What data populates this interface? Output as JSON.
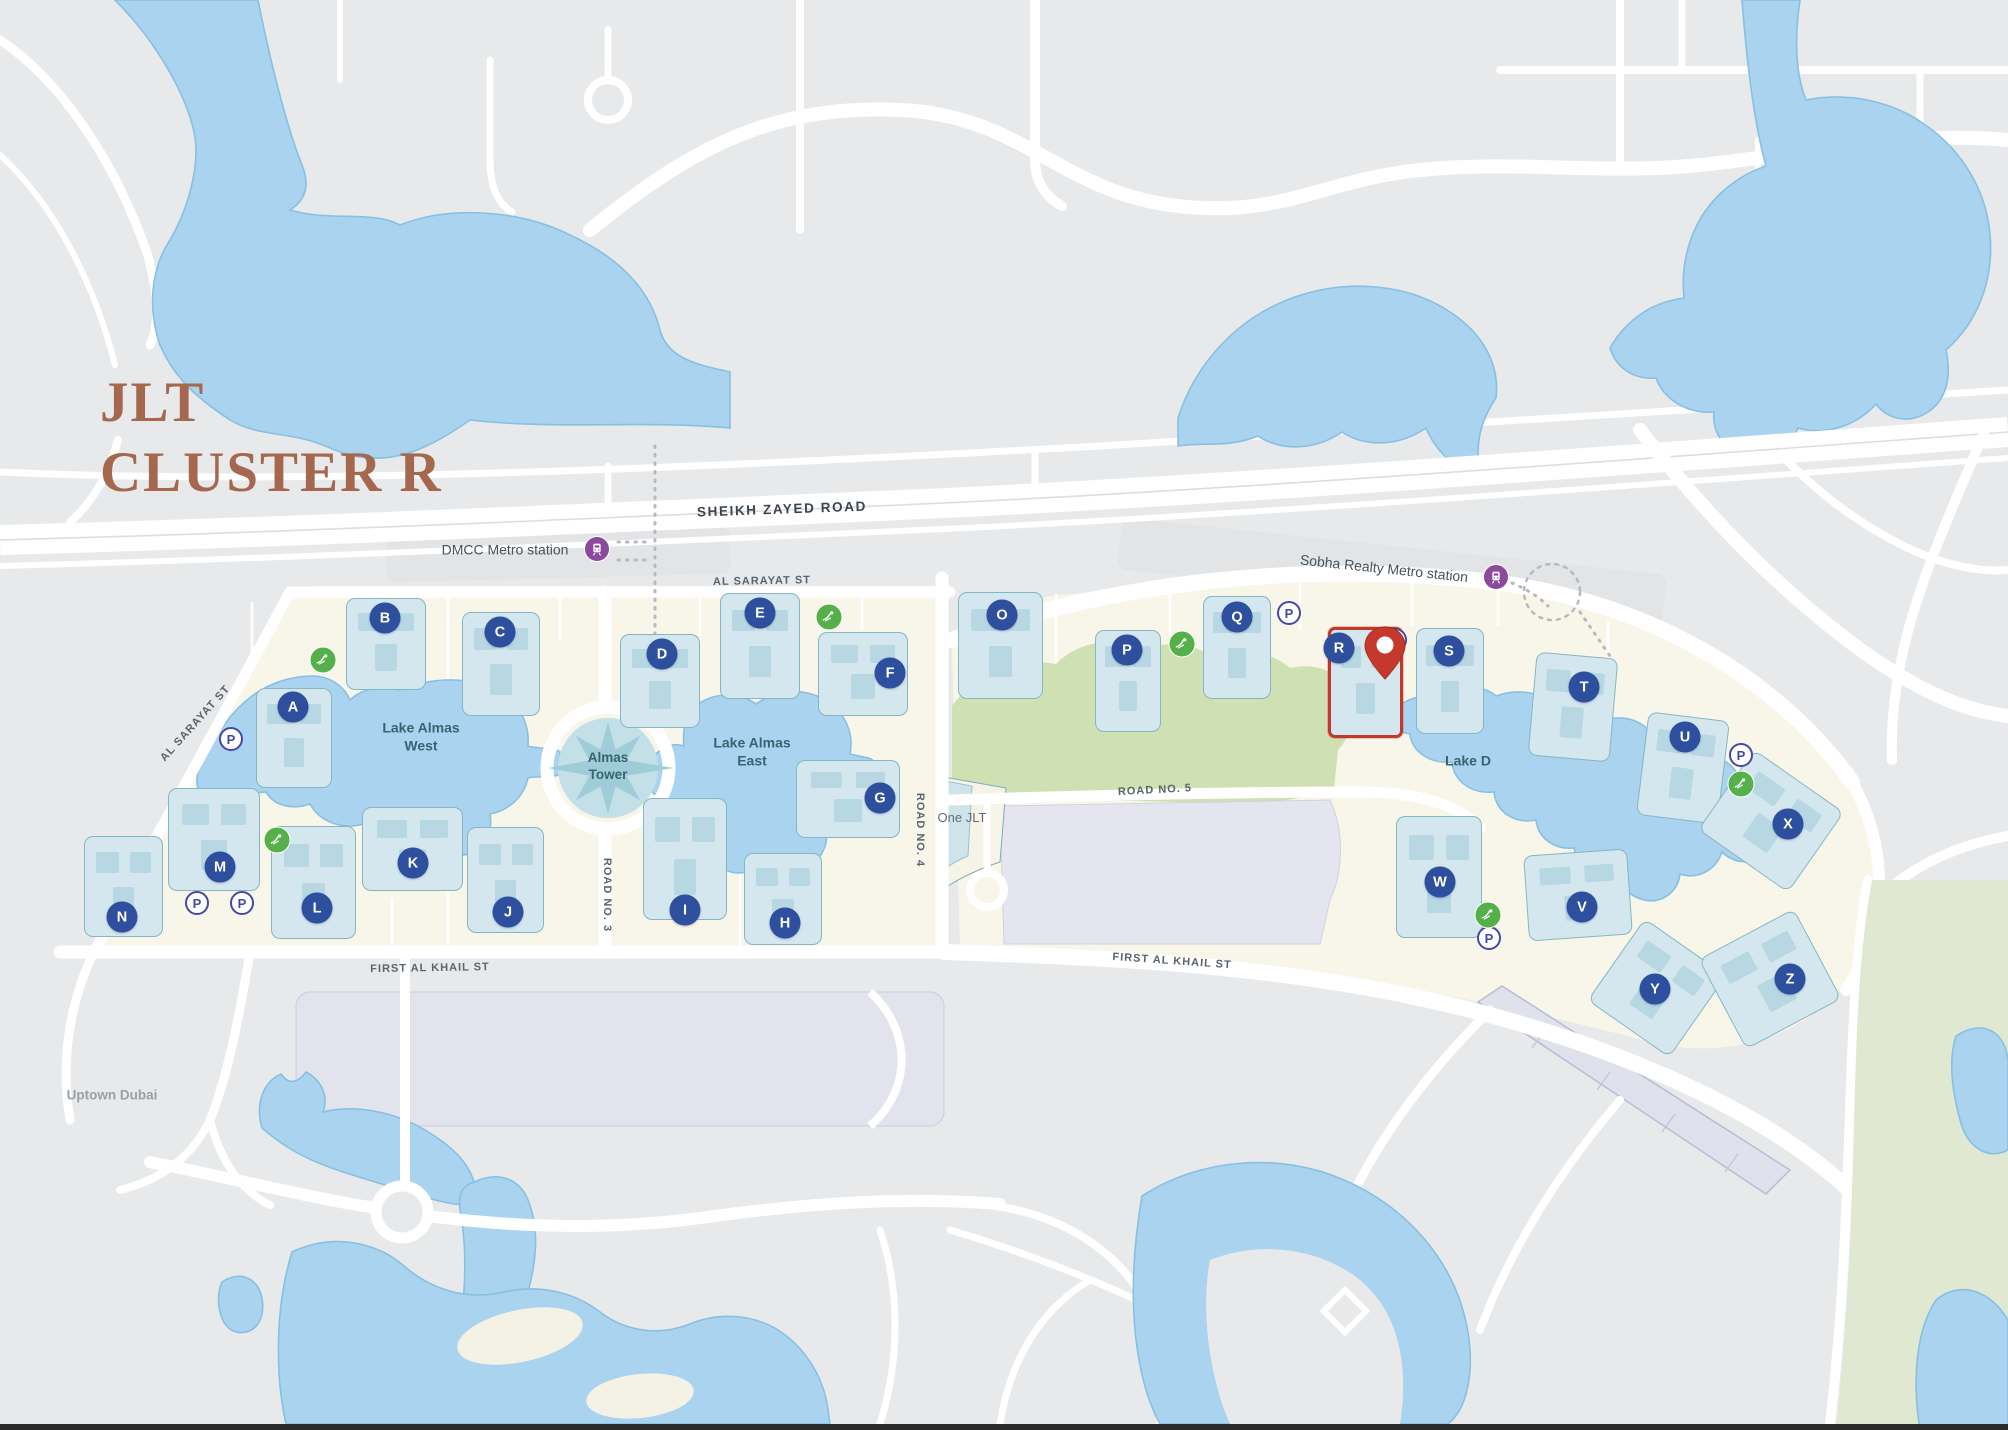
{
  "title": {
    "line1": "JLT",
    "line2": "CLUSTER R"
  },
  "selected_cluster": "R",
  "palette": {
    "background": "#e7e9ea",
    "water": "#a9d3ee",
    "water_edge": "#88c0e2",
    "island": "#f8f5e9",
    "park_green": "#cfe0b2",
    "golf_green": "#e0e8d2",
    "road": "#ffffff",
    "parking_lot": "#e2e3ed",
    "building": "#d5e7ee",
    "building_unit": "#b7d8e3",
    "badge_blue": "#2d4f9e",
    "parking_ring": "#4747a5",
    "leisure_green": "#55b04a",
    "metro_purple": "#8b4a9c",
    "highlight_red": "#c0392b",
    "title_brown": "#a5684f"
  },
  "icons": {
    "parking": "P-in-circle parking icon",
    "metro": "train-in-purple-circle metro icon",
    "leisure": "white-figure-in-green-circle leisure icon",
    "pin": "red map location pin",
    "compass": "eight-point star at Almas Tower"
  },
  "labels": [
    {
      "name": "road-label-sheikh-zayed",
      "text": "SHEIKH ZAYED ROAD",
      "x": 782,
      "y": 510,
      "rot": -2,
      "cls": "road-major"
    },
    {
      "name": "metro-label-dmcc",
      "text": "DMCC Metro station",
      "x": 505,
      "y": 550,
      "rot": 0,
      "cls": "metro"
    },
    {
      "name": "metro-label-sobha",
      "text": "Sobha Realty Metro station",
      "x": 1384,
      "y": 569,
      "rot": 6,
      "cls": "metro"
    },
    {
      "name": "road-label-al-sarayat-top",
      "text": "AL SARAYAT ST",
      "x": 762,
      "y": 582,
      "rot": -1,
      "cls": "road"
    },
    {
      "name": "road-label-al-sarayat-diagonal",
      "text": "AL SARAYAT ST",
      "x": 196,
      "y": 724,
      "rot": -48,
      "cls": "road"
    },
    {
      "name": "road-label-road-3",
      "text": "ROAD NO. 3",
      "x": 606,
      "y": 895,
      "rot": 90,
      "cls": "road"
    },
    {
      "name": "road-label-road-4",
      "text": "ROAD NO. 4",
      "x": 919,
      "y": 830,
      "rot": 90,
      "cls": "road"
    },
    {
      "name": "road-label-road-5",
      "text": "ROAD NO. 5",
      "x": 1155,
      "y": 791,
      "rot": -3,
      "cls": "road"
    },
    {
      "name": "road-label-first-al-khail-left",
      "text": "FIRST AL KHAIL ST",
      "x": 430,
      "y": 969,
      "rot": -1,
      "cls": "road"
    },
    {
      "name": "road-label-first-al-khail-right",
      "text": "FIRST AL KHAIL ST",
      "x": 1172,
      "y": 962,
      "rot": 4,
      "cls": "road"
    },
    {
      "name": "lake-label-almas-west",
      "text": "Lake Almas\nWest",
      "x": 421,
      "y": 737,
      "rot": 0,
      "cls": "lake"
    },
    {
      "name": "lake-label-almas-east",
      "text": "Lake Almas\nEast",
      "x": 752,
      "y": 752,
      "rot": 0,
      "cls": "lake"
    },
    {
      "name": "lake-label-lake-d",
      "text": "Lake D",
      "x": 1468,
      "y": 761,
      "rot": 0,
      "cls": "lake"
    },
    {
      "name": "almas-tower-label",
      "text": "Almas\nTower",
      "x": 608,
      "y": 767,
      "rot": 0,
      "cls": "almas"
    },
    {
      "name": "place-label-one-jlt",
      "text": "One JLT",
      "x": 962,
      "y": 818,
      "rot": 0,
      "cls": "place"
    },
    {
      "name": "place-label-uptown-dubai",
      "text": "Uptown Dubai",
      "x": 112,
      "y": 1096,
      "rot": 0,
      "cls": "muted"
    }
  ],
  "metro_stations": [
    {
      "name": "dmcc-metro-station",
      "label": "DMCC Metro station",
      "icon_x": 597,
      "icon_y": 549
    },
    {
      "name": "sobha-realty-metro-station",
      "label": "Sobha Realty Metro station",
      "icon_x": 1496,
      "icon_y": 577
    }
  ],
  "towers": [
    {
      "letter": "A",
      "cx": 293,
      "cy": 707,
      "bx": 256,
      "by": 688,
      "bw": 76,
      "bh": 100,
      "rot": 0
    },
    {
      "letter": "B",
      "cx": 385,
      "cy": 618,
      "bx": 346,
      "by": 598,
      "bw": 80,
      "bh": 92,
      "rot": 0
    },
    {
      "letter": "C",
      "cx": 500,
      "cy": 632,
      "bx": 462,
      "by": 612,
      "bw": 78,
      "bh": 104,
      "rot": 0
    },
    {
      "letter": "D",
      "cx": 662,
      "cy": 654,
      "bx": 620,
      "by": 634,
      "bw": 80,
      "bh": 94,
      "rot": 0
    },
    {
      "letter": "E",
      "cx": 760,
      "cy": 613,
      "bx": 720,
      "by": 593,
      "bw": 80,
      "bh": 106,
      "rot": 0
    },
    {
      "letter": "F",
      "cx": 890,
      "cy": 673,
      "bx": 818,
      "by": 632,
      "bw": 90,
      "bh": 84,
      "rot": 0
    },
    {
      "letter": "G",
      "cx": 880,
      "cy": 798,
      "bx": 796,
      "by": 760,
      "bw": 104,
      "bh": 78,
      "rot": 0
    },
    {
      "letter": "H",
      "cx": 785,
      "cy": 923,
      "bx": 744,
      "by": 853,
      "bw": 78,
      "bh": 92,
      "rot": 0
    },
    {
      "letter": "I",
      "cx": 685,
      "cy": 910,
      "bx": 643,
      "by": 798,
      "bw": 84,
      "bh": 122,
      "rot": 0
    },
    {
      "letter": "J",
      "cx": 508,
      "cy": 912,
      "bx": 467,
      "by": 827,
      "bw": 77,
      "bh": 106,
      "rot": 0
    },
    {
      "letter": "K",
      "cx": 413,
      "cy": 863,
      "bx": 362,
      "by": 807,
      "bw": 101,
      "bh": 84,
      "rot": 0
    },
    {
      "letter": "L",
      "cx": 317,
      "cy": 908,
      "bx": 271,
      "by": 826,
      "bw": 85,
      "bh": 113,
      "rot": 0
    },
    {
      "letter": "M",
      "cx": 220,
      "cy": 867,
      "bx": 168,
      "by": 788,
      "bw": 92,
      "bh": 103,
      "rot": 0
    },
    {
      "letter": "N",
      "cx": 122,
      "cy": 917,
      "bx": 84,
      "by": 836,
      "bw": 79,
      "bh": 101,
      "rot": 0
    },
    {
      "letter": "O",
      "cx": 1002,
      "cy": 615,
      "bx": 958,
      "by": 592,
      "bw": 85,
      "bh": 107,
      "rot": 0
    },
    {
      "letter": "P",
      "cx": 1127,
      "cy": 650,
      "bx": 1095,
      "by": 630,
      "bw": 66,
      "bh": 102,
      "rot": 0
    },
    {
      "letter": "Q",
      "cx": 1237,
      "cy": 617,
      "bx": 1203,
      "by": 596,
      "bw": 68,
      "bh": 103,
      "rot": 0
    },
    {
      "letter": "R",
      "cx": 1339,
      "cy": 648,
      "bx": 1328,
      "by": 627,
      "bw": 75,
      "bh": 111,
      "rot": 0,
      "highlight": true
    },
    {
      "letter": "S",
      "cx": 1449,
      "cy": 651,
      "bx": 1416,
      "by": 628,
      "bw": 68,
      "bh": 106,
      "rot": 0
    },
    {
      "letter": "T",
      "cx": 1584,
      "cy": 687,
      "bx": 1532,
      "by": 655,
      "bw": 82,
      "bh": 104,
      "rot": 5
    },
    {
      "letter": "U",
      "cx": 1685,
      "cy": 737,
      "bx": 1642,
      "by": 716,
      "bw": 82,
      "bh": 104,
      "rot": 7
    },
    {
      "letter": "V",
      "cx": 1582,
      "cy": 907,
      "bx": 1526,
      "by": 852,
      "bw": 104,
      "bh": 86,
      "rot": -4
    },
    {
      "letter": "W",
      "cx": 1440,
      "cy": 882,
      "bx": 1396,
      "by": 816,
      "bw": 86,
      "bh": 122,
      "rot": 0
    },
    {
      "letter": "X",
      "cx": 1788,
      "cy": 824,
      "bx": 1716,
      "by": 772,
      "bw": 110,
      "bh": 98,
      "rot": 35
    },
    {
      "letter": "Y",
      "cx": 1655,
      "cy": 989,
      "bx": 1607,
      "by": 938,
      "bw": 100,
      "bh": 100,
      "rot": 35
    },
    {
      "letter": "Z",
      "cx": 1790,
      "cy": 979,
      "bx": 1716,
      "by": 928,
      "bw": 108,
      "bh": 102,
      "rot": -28
    }
  ],
  "parking_icons": [
    {
      "x": 231,
      "y": 739
    },
    {
      "x": 197,
      "y": 903
    },
    {
      "x": 242,
      "y": 903
    },
    {
      "x": 1289,
      "y": 613
    },
    {
      "x": 1395,
      "y": 640
    },
    {
      "x": 1741,
      "y": 755
    },
    {
      "x": 1489,
      "y": 938
    }
  ],
  "leisure_icons": [
    {
      "x": 323,
      "y": 660
    },
    {
      "x": 277,
      "y": 840
    },
    {
      "x": 829,
      "y": 617
    },
    {
      "x": 1182,
      "y": 644
    },
    {
      "x": 1488,
      "y": 915
    },
    {
      "x": 1741,
      "y": 784
    }
  ],
  "pin": {
    "x": 1385,
    "y": 686,
    "label": "cluster-r-location"
  }
}
